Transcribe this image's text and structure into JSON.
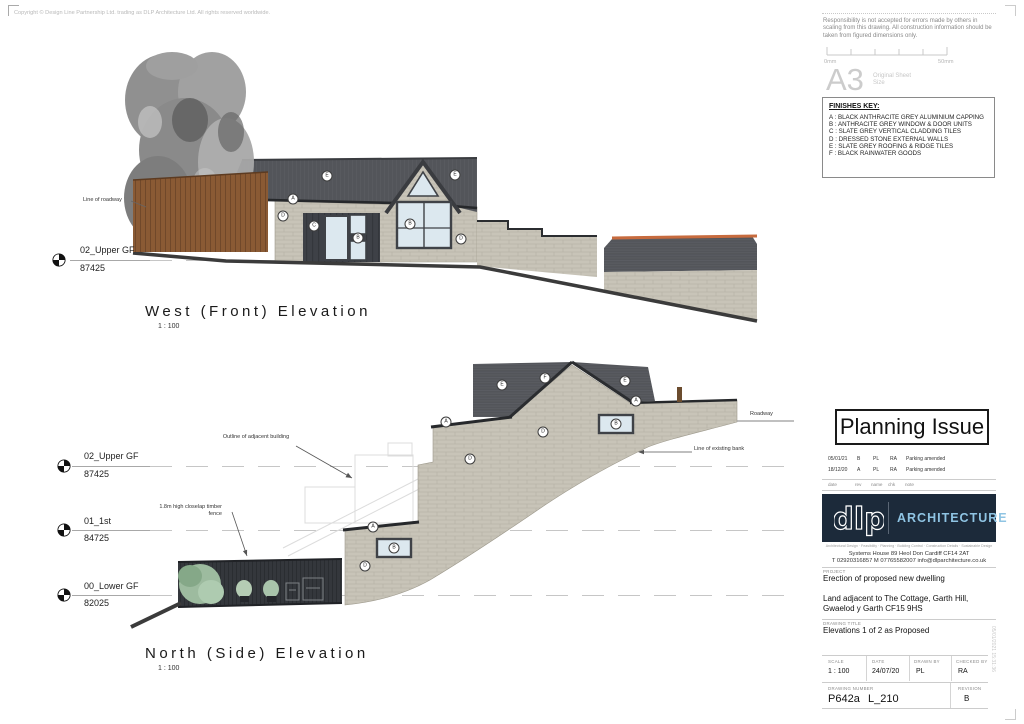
{
  "copyright": "Copyright © Design Line Partnership Ltd. trading as DLP Architecture Ltd. All rights reserved worldwide.",
  "disclaimer": "Responsibility is not accepted for errors made by others in scaling from this drawing.  All construction information should be taken from figured dimensions only.",
  "scale_bar": {
    "start": "0mm",
    "end": "50mm"
  },
  "sheet_size": {
    "size": "A3",
    "caption": "Original Sheet Size"
  },
  "finishes_key": {
    "title": "FINISHES KEY:",
    "items": [
      "A : BLACK ANTHRACITE GREY ALUMINIUM CAPPING",
      "B : ANTHRACITE GREY WINDOW & DOOR UNITS",
      "C : SLATE GREY VERTICAL CLADDING TILES",
      "D : DRESSED STONE EXTERNAL WALLS",
      "E : SLATE GREY ROOFING & RIDGE TILES",
      "F : BLACK RAINWATER GOODS"
    ]
  },
  "west": {
    "title": "West (Front) Elevation",
    "scale": "1 : 100",
    "level": {
      "name": "02_Upper GF",
      "value": "87425"
    },
    "roadway_note": "Line of roadway",
    "callouts": [
      {
        "t": "E",
        "x": 327,
        "y": 176
      },
      {
        "t": "E",
        "x": 455,
        "y": 175
      },
      {
        "t": "A",
        "x": 293,
        "y": 199
      },
      {
        "t": "D",
        "x": 283,
        "y": 216
      },
      {
        "t": "C",
        "x": 314,
        "y": 226
      },
      {
        "t": "B",
        "x": 358,
        "y": 238
      },
      {
        "t": "B",
        "x": 410,
        "y": 224
      },
      {
        "t": "D",
        "x": 461,
        "y": 239
      }
    ]
  },
  "north": {
    "title": "North (Side) Elevation",
    "scale": "1 : 100",
    "levels": [
      {
        "name": "02_Upper GF",
        "value": "87425"
      },
      {
        "name": "01_1st",
        "value": "84725"
      },
      {
        "name": "00_Lower GF",
        "value": "82025"
      }
    ],
    "notes": {
      "outline": "Outline of adjacent building",
      "fence": "1.8m high closelap timber fence",
      "roadway": "Roadway",
      "bank": "Line of existing bank"
    },
    "callouts": [
      {
        "t": "E",
        "x": 502,
        "y": 385
      },
      {
        "t": "F",
        "x": 545,
        "y": 378
      },
      {
        "t": "E",
        "x": 625,
        "y": 381
      },
      {
        "t": "A",
        "x": 446,
        "y": 422
      },
      {
        "t": "A",
        "x": 636,
        "y": 401
      },
      {
        "t": "D",
        "x": 543,
        "y": 432
      },
      {
        "t": "D",
        "x": 470,
        "y": 459
      },
      {
        "t": "B",
        "x": 616,
        "y": 424
      },
      {
        "t": "A",
        "x": 373,
        "y": 527
      },
      {
        "t": "B",
        "x": 394,
        "y": 548
      },
      {
        "t": "D",
        "x": 365,
        "y": 566
      }
    ]
  },
  "stamp": {
    "title": "Planning Issue"
  },
  "revisions": {
    "headers": {
      "date": "date",
      "rev": "rev",
      "name": "name",
      "chk": "chk",
      "note": "note"
    },
    "rows": [
      {
        "date": "05/01/21",
        "rev": "B",
        "name": "PL",
        "chk": "RA",
        "note": "Parking amended"
      },
      {
        "date": "18/12/20",
        "rev": "A",
        "name": "PL",
        "chk": "RA",
        "note": "Parking amended"
      }
    ]
  },
  "firm": {
    "logo_text": "dlp",
    "name": "ARCHITECTURE",
    "services": "Architectural Design · Feasibility · Planning · Building Control · Construction Details · Sustainable Design",
    "address": "Systems House    89 Heol Don    Cardiff    CF14 2AT",
    "contacts": "T  02920316857     M  07765582007     info@dlparchitecture.co.uk"
  },
  "project": {
    "label": "PROJECT",
    "description": "Erection of proposed new dwelling",
    "site1": "Land adjacent to The Cottage, Garth Hill,",
    "site2": "Gwaelod y Garth CF15 9HS"
  },
  "drawing_title": {
    "label": "DRAWING TITLE",
    "value": "Elevations 1 of 2 as Proposed"
  },
  "title_block": {
    "scale_label": "SCALE",
    "scale": "1 : 100",
    "date_label": "DATE",
    "date": "24/07/20",
    "drawn_label": "DRAWN BY",
    "drawn": "PL",
    "checked_label": "CHECKED BY",
    "checked": "RA",
    "number_label": "DRAWING NUMBER",
    "number": "P642a",
    "number_suffix": "L_210",
    "revision_label": "REVISION",
    "revision": "B"
  },
  "print_stamp": "05/01/2021 15:31:36",
  "colors": {
    "stone": "#c8c4b8",
    "roof": "#53555a",
    "cladding": "#3e4147",
    "accent_blue": "#8fc4e3",
    "navy": "#1c2a3a",
    "ridge_orange": "#c76b3e"
  }
}
